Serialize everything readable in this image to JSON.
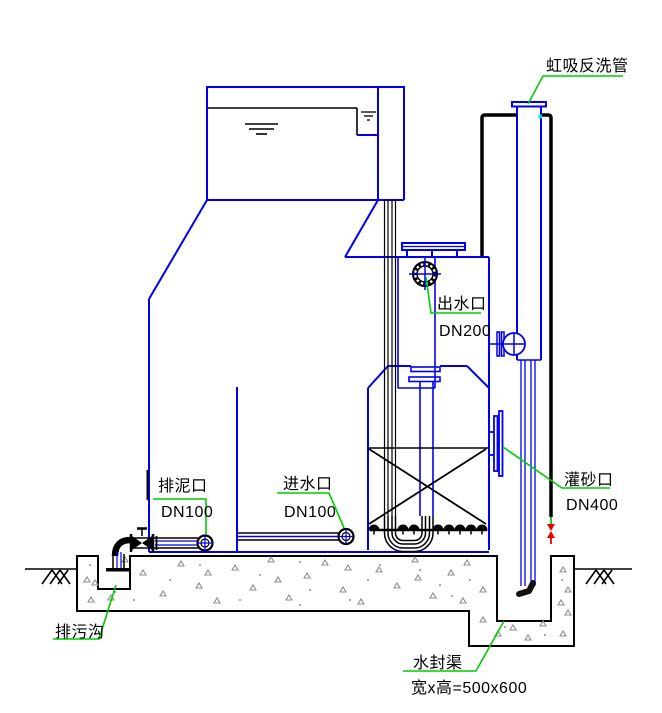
{
  "drawing": {
    "labels": {
      "siphon_backwash_pipe": "虹吸反洗管",
      "outlet_name": "出水口",
      "outlet_size": "DN200",
      "sludge_name": "排泥口",
      "sludge_size": "DN100",
      "inlet_name": "进水口",
      "inlet_size": "DN100",
      "sand_name": "灌砂口",
      "sand_size": "DN400",
      "ditch_name": "排污沟",
      "seal_name": "水封渠",
      "seal_dim": "宽x高=500x600"
    },
    "colors": {
      "line_blue": "#0000ee",
      "line_black": "#000000",
      "leader_green": "#00cc00",
      "valve_red": "#ee0000",
      "concrete_gray": "#8f8f8f",
      "marker_cyan": "#00dddd"
    }
  }
}
